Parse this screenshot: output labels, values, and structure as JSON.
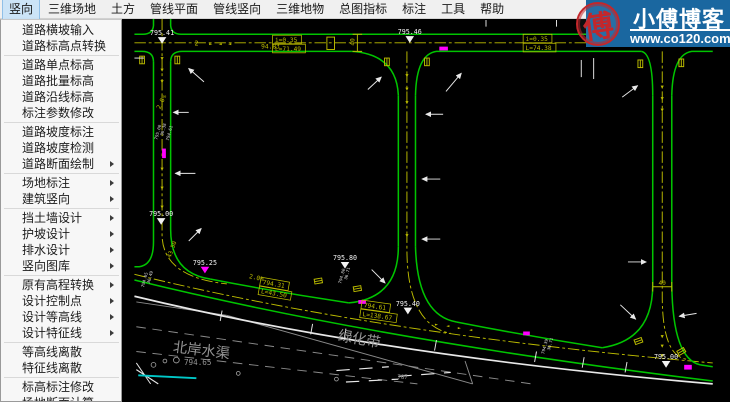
{
  "menubar": {
    "items": [
      {
        "label": "竖向",
        "active": true
      },
      {
        "label": "三维场地",
        "active": false
      },
      {
        "label": "土方",
        "active": false
      },
      {
        "label": "管线平面",
        "active": false
      },
      {
        "label": "管线竖向",
        "active": false
      },
      {
        "label": "三维地物",
        "active": false
      },
      {
        "label": "总图指标",
        "active": false
      },
      {
        "label": "标注",
        "active": false
      },
      {
        "label": "工具",
        "active": false
      },
      {
        "label": "帮助",
        "active": false
      }
    ]
  },
  "menu": {
    "items": [
      {
        "label": "道路横坡输入",
        "submenu": false
      },
      {
        "label": "道路标高点转换",
        "submenu": false
      },
      {
        "type": "sep"
      },
      {
        "label": "道路单点标高",
        "submenu": false
      },
      {
        "label": "道路批量标高",
        "submenu": false
      },
      {
        "label": "道路沿线标高",
        "submenu": false
      },
      {
        "label": "标注参数修改",
        "submenu": false
      },
      {
        "type": "sep"
      },
      {
        "label": "道路坡度标注",
        "submenu": false
      },
      {
        "label": "道路坡度检测",
        "submenu": false
      },
      {
        "label": "道路断面绘制",
        "submenu": true
      },
      {
        "type": "sep"
      },
      {
        "label": "场地标注",
        "submenu": true
      },
      {
        "label": "建筑竖向",
        "submenu": true
      },
      {
        "type": "sep"
      },
      {
        "label": "挡土墙设计",
        "submenu": true
      },
      {
        "label": "护坡设计",
        "submenu": true
      },
      {
        "label": "排水设计",
        "submenu": true
      },
      {
        "label": "竖向图库",
        "submenu": true
      },
      {
        "type": "sep"
      },
      {
        "label": "原有高程转换",
        "submenu": true
      },
      {
        "label": "设计控制点",
        "submenu": true
      },
      {
        "label": "设计等高线",
        "submenu": true
      },
      {
        "label": "设计特征线",
        "submenu": true
      },
      {
        "type": "sep"
      },
      {
        "label": "等高线离散",
        "submenu": false
      },
      {
        "label": "特征线离散",
        "submenu": false
      },
      {
        "type": "sep"
      },
      {
        "label": "标高标注修改",
        "submenu": false
      },
      {
        "label": "场地断面计算",
        "submenu": false
      }
    ]
  },
  "watermark": {
    "title": "小傅博客",
    "url": "www.co120.com",
    "seal": "傅",
    "bg": "#1a67a0",
    "seal_color": "#c3272b"
  },
  "canvas": {
    "colors": {
      "road": "#00c400",
      "centerline": "#bcbc00",
      "white": "#e8e8e8",
      "gray": "#949494",
      "magenta": "#ff00ff",
      "cyan": "#00c8c8"
    },
    "elevation_markers": [
      {
        "t": "795.41",
        "x": 152,
        "y": 36,
        "c": "#f2f2f2"
      },
      {
        "t": "795.46",
        "x": 412,
        "y": 35,
        "c": "#f2f2f2"
      },
      {
        "t": "795.00",
        "x": 151,
        "y": 226,
        "c": "#f2f2f2"
      },
      {
        "t": "795.25",
        "x": 197,
        "y": 277,
        "c": "#ff00ff"
      },
      {
        "t": "795.80",
        "x": 344,
        "y": 272,
        "c": "#f2f2f2"
      },
      {
        "t": "795.40",
        "x": 410,
        "y": 320,
        "c": "#f2f2f2"
      },
      {
        "t": "795.00",
        "x": 681,
        "y": 376,
        "c": "#f2f2f2"
      }
    ],
    "boxed_labels": [
      {
        "l1": "i=0.35",
        "l2": "L=71.49",
        "x": 268,
        "y": 36,
        "rot": 0
      },
      {
        "l1": "i=0.35",
        "l2": "L=74.38",
        "x": 531,
        "y": 35,
        "rot": 0
      },
      {
        "l1": "794.61",
        "l2": "L=138.67",
        "x": 362,
        "y": 314,
        "rot": 8
      },
      {
        "l1": "794.31",
        "l2": "L=43.50",
        "x": 256,
        "y": 290,
        "rot": 10
      }
    ],
    "yellow_texts": [
      {
        "t": "2",
        "x": 186,
        "y": 47,
        "rot": 0,
        "s": 7
      },
      {
        "t": "94.83",
        "x": 256,
        "y": 50,
        "rot": 0,
        "s": 6.5
      },
      {
        "t": "2.0%",
        "x": 150,
        "y": 114,
        "rot": -65,
        "s": 6.5
      },
      {
        "t": "2.0%",
        "x": 243,
        "y": 291,
        "rot": 12,
        "s": 6.5
      },
      {
        "t": "43.50",
        "x": 161,
        "y": 270,
        "rot": -70,
        "s": 6
      },
      {
        "t": "40",
        "x": 354,
        "y": 47,
        "rot": -90,
        "s": 6.5
      },
      {
        "t": "40",
        "x": 673,
        "y": 298,
        "rot": 0,
        "s": 6.5
      }
    ],
    "gray_texts": [
      {
        "t": "绿化带",
        "x": 336,
        "y": 356,
        "rot": 10,
        "s": 15
      },
      {
        "t": "北岸水渠",
        "x": 163,
        "y": 368,
        "rot": 7,
        "s": 15
      },
      {
        "t": "794.65",
        "x": 175,
        "y": 382,
        "rot": 0,
        "s": 8
      },
      {
        "t": "787",
        "x": 399,
        "y": 397,
        "rot": 0,
        "s": 6
      }
    ],
    "tiny_texts": [
      {
        "t": "795.00",
        "x": 147,
        "y": 146
      },
      {
        "t": "36.38",
        "x": 153,
        "y": 142
      },
      {
        "t": "794.61",
        "x": 159,
        "y": 147
      },
      {
        "t": "794.80",
        "x": 340,
        "y": 297
      },
      {
        "t": "36.71",
        "x": 346,
        "y": 293
      },
      {
        "t": "794.39",
        "x": 553,
        "y": 371
      },
      {
        "t": "36.71",
        "x": 559,
        "y": 367
      },
      {
        "t": "794.65",
        "x": 133,
        "y": 301
      },
      {
        "t": "36.49",
        "x": 139,
        "y": 297
      }
    ],
    "center_markers": [
      {
        "g": "▼",
        "x": 152,
        "y": 62
      },
      {
        "g": "▼",
        "x": 152,
        "y": 74
      },
      {
        "g": "▼",
        "x": 152,
        "y": 86
      },
      {
        "g": "▼",
        "x": 152,
        "y": 178
      },
      {
        "g": "▼",
        "x": 152,
        "y": 198
      },
      {
        "g": "▼",
        "x": 152,
        "y": 218
      },
      {
        "g": "▼",
        "x": 409,
        "y": 80
      },
      {
        "g": "▼",
        "x": 409,
        "y": 94
      },
      {
        "g": "▼",
        "x": 409,
        "y": 108
      },
      {
        "g": "▼",
        "x": 409,
        "y": 248
      },
      {
        "g": "▼",
        "x": 677,
        "y": 92
      },
      {
        "g": "▼",
        "x": 677,
        "y": 104
      },
      {
        "g": "▼",
        "x": 677,
        "y": 116
      },
      {
        "g": "▼",
        "x": 677,
        "y": 354
      },
      {
        "g": "▼",
        "x": 677,
        "y": 364
      },
      {
        "g": "▼",
        "x": 677,
        "y": 374
      },
      {
        "g": "►",
        "x": 203,
        "y": 47
      },
      {
        "g": "◄",
        "x": 213,
        "y": 47
      },
      {
        "g": "◄",
        "x": 223,
        "y": 47
      },
      {
        "g": "►",
        "x": 440,
        "y": 341
      },
      {
        "g": "◄",
        "x": 452,
        "y": 343
      },
      {
        "g": "►",
        "x": 464,
        "y": 345
      },
      {
        "g": "◄",
        "x": 476,
        "y": 347
      }
    ],
    "gate_symbols": [
      {
        "x": 131,
        "y": 62,
        "rot": 0
      },
      {
        "x": 168,
        "y": 62,
        "rot": 0
      },
      {
        "x": 388,
        "y": 64,
        "rot": 0
      },
      {
        "x": 430,
        "y": 64,
        "rot": 0
      },
      {
        "x": 654,
        "y": 66,
        "rot": 0
      },
      {
        "x": 697,
        "y": 65,
        "rot": 0
      },
      {
        "x": 316,
        "y": 294,
        "rot": 80
      },
      {
        "x": 357,
        "y": 302,
        "rot": 80
      },
      {
        "x": 652,
        "y": 357,
        "rot": 70
      },
      {
        "x": 697,
        "y": 368,
        "rot": 60
      }
    ],
    "magenta_marks": [
      {
        "x": 443,
        "y": 48,
        "w": 9,
        "h": 4
      },
      {
        "x": 152,
        "y": 155,
        "w": 4,
        "h": 10
      },
      {
        "x": 358,
        "y": 314,
        "w": 8,
        "h": 4
      },
      {
        "x": 531,
        "y": 347,
        "w": 7,
        "h": 4
      },
      {
        "x": 700,
        "y": 382,
        "w": 8,
        "h": 5
      }
    ],
    "white_arrows": [
      {
        "x1": 196,
        "y1": 85,
        "x2": 180,
        "y2": 71
      },
      {
        "x1": 180,
        "y1": 117,
        "x2": 164,
        "y2": 117
      },
      {
        "x1": 368,
        "y1": 93,
        "x2": 382,
        "y2": 80
      },
      {
        "x1": 450,
        "y1": 95,
        "x2": 466,
        "y2": 76
      },
      {
        "x1": 447,
        "y1": 119,
        "x2": 429,
        "y2": 119
      },
      {
        "x1": 444,
        "y1": 187,
        "x2": 425,
        "y2": 187
      },
      {
        "x1": 444,
        "y1": 250,
        "x2": 425,
        "y2": 250
      },
      {
        "x1": 372,
        "y1": 282,
        "x2": 386,
        "y2": 296
      },
      {
        "x1": 633,
        "y1": 319,
        "x2": 649,
        "y2": 334
      },
      {
        "x1": 641,
        "y1": 274,
        "x2": 660,
        "y2": 274
      },
      {
        "x1": 713,
        "y1": 328,
        "x2": 695,
        "y2": 331
      },
      {
        "x1": 187,
        "y1": 181,
        "x2": 166,
        "y2": 181
      },
      {
        "x1": 180,
        "y1": 252,
        "x2": 193,
        "y2": 239
      },
      {
        "x1": 635,
        "y1": 101,
        "x2": 651,
        "y2": 89
      }
    ],
    "white_ticks": [
      {
        "x1": 492,
        "y1": 20,
        "x2": 492,
        "y2": 27
      },
      {
        "x1": 566,
        "y1": 20,
        "x2": 566,
        "y2": 27
      },
      {
        "x1": 592,
        "y1": 62,
        "x2": 592,
        "y2": 80
      },
      {
        "x1": 605,
        "y1": 60,
        "x2": 605,
        "y2": 82
      },
      {
        "x1": 123,
        "y1": 60,
        "x2": 133,
        "y2": 60
      },
      {
        "x1": 215,
        "y1": 325,
        "x2": 213,
        "y2": 336
      },
      {
        "x1": 310,
        "y1": 339,
        "x2": 308,
        "y2": 350
      },
      {
        "x1": 345,
        "y1": 344,
        "x2": 343,
        "y2": 355
      },
      {
        "x1": 440,
        "y1": 356,
        "x2": 438,
        "y2": 367
      },
      {
        "x1": 545,
        "y1": 368,
        "x2": 543,
        "y2": 379
      },
      {
        "x1": 595,
        "y1": 374,
        "x2": 593,
        "y2": 385
      },
      {
        "x1": 640,
        "y1": 379,
        "x2": 638,
        "y2": 390
      }
    ],
    "circles": [
      {
        "x": 143,
        "y": 382,
        "r": 2.5
      },
      {
        "x": 155,
        "y": 378,
        "r": 2
      },
      {
        "x": 232,
        "y": 391,
        "r": 2
      },
      {
        "x": 335,
        "y": 397,
        "r": 2
      },
      {
        "x": 167,
        "y": 377,
        "r": 3
      }
    ]
  }
}
